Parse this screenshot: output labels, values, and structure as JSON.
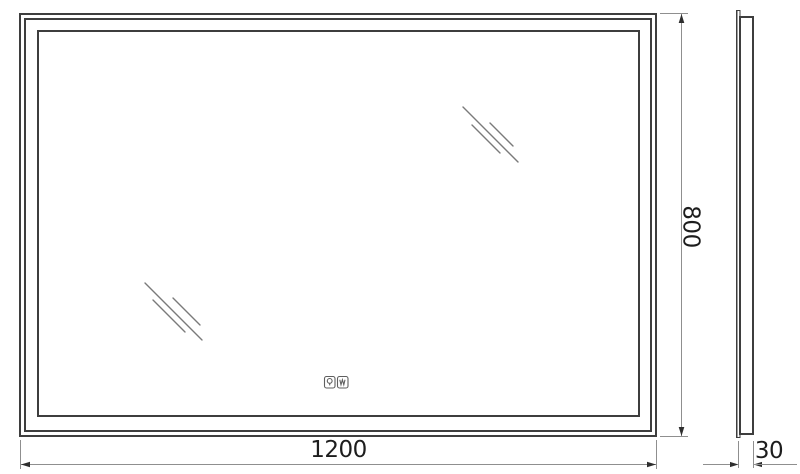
{
  "drawing": {
    "kind": "mirror-technical-drawing",
    "labels": {
      "width": "1200",
      "height": "800",
      "depth": "30"
    },
    "icons": {
      "light": "light-control-icon",
      "demister": "demister-control-icon"
    },
    "colors": {
      "outline": "#3e3e3e",
      "dimension": "#8f8f8f",
      "arrow": "#2e2e2e",
      "reflection": "#7a7a7a",
      "icon": "#5f5f5f",
      "text": "#1d1d1d",
      "background": "#ffffff"
    }
  }
}
